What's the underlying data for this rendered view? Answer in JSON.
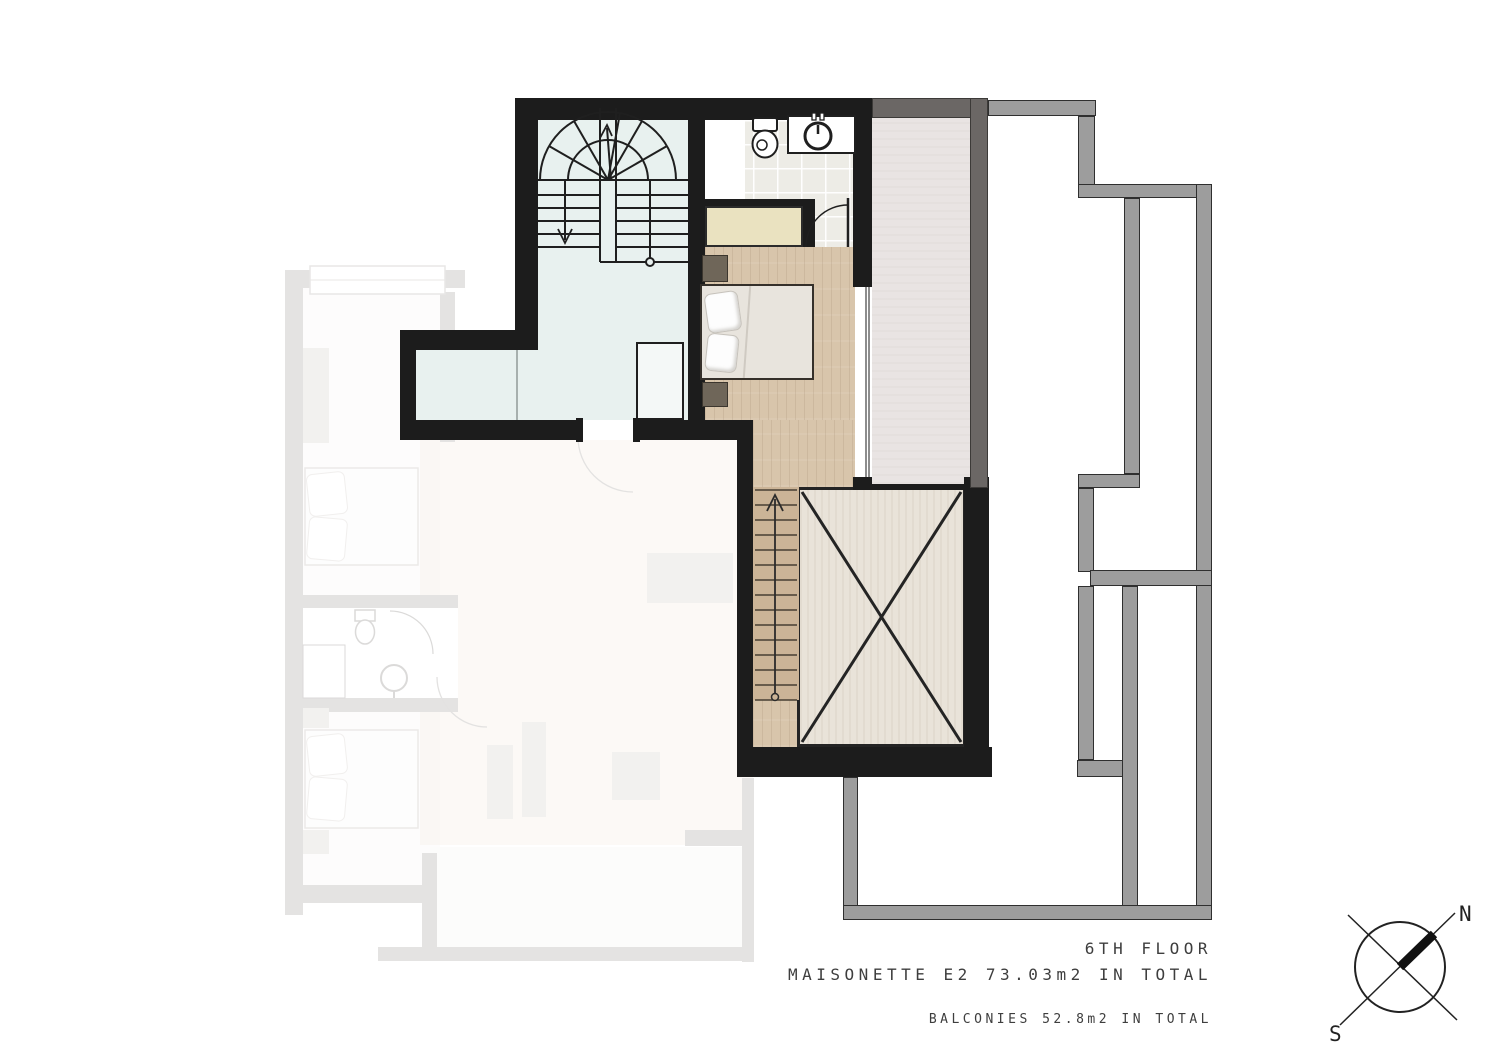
{
  "title": {
    "line1": "6TH FLOOR",
    "line2": "MAISONETTE E2 73.03m2 IN TOTAL",
    "line3": "BALCONIES 52.8m2 IN TOTAL"
  },
  "compass": {
    "north_label": "N",
    "south_label": "S"
  },
  "icons": [
    "toilet-icon",
    "washbasin-icon",
    "winder-staircase-icon",
    "stairs-down-icon",
    "direction-arrow-icon",
    "void-cross-icon",
    "door-swing-icon",
    "bed-icon",
    "compass-rose-icon"
  ],
  "colors": {
    "wall": "#1c1c1c",
    "darkWall": "#6b6765",
    "rail": "#9d9d9d",
    "stairFloor": "#e8f1ef",
    "tile": "#edece6",
    "wood": "#d8c5ab",
    "woodDark": "#cbb497",
    "closet": "#eae2c0",
    "voidFloor": "#e9e3d9",
    "balconyFloor": "#e9e4e3",
    "lineInk": "#1f1f1f",
    "ghost": "#cbc9c7",
    "text": "#3e3e3e"
  }
}
